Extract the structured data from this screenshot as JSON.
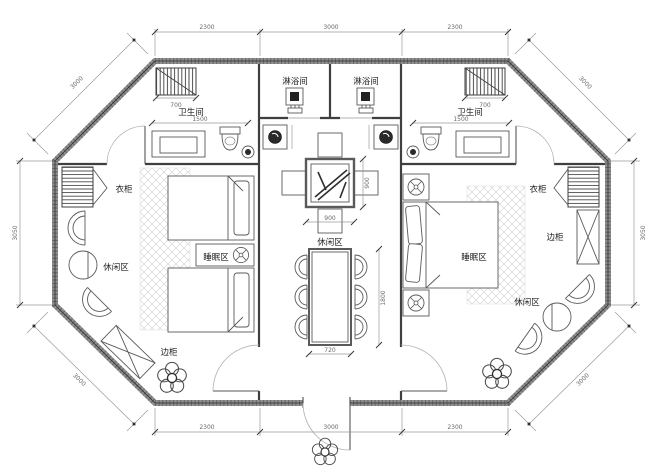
{
  "drawing": {
    "type": "octagonal suite floor plan",
    "background": "#ffffff",
    "wall_color": "#8f8f8f",
    "line_color": "#5a5a5a",
    "dim_color": "#6b6b6b"
  },
  "labels": {
    "shower_left": "淋浴间",
    "shower_right": "淋浴间",
    "bathroom_left": "卫生间",
    "bathroom_right": "卫生间",
    "wardrobe_left": "衣柜",
    "wardrobe_right": "衣柜",
    "sleeping_left": "睡眠区",
    "sleeping_right": "睡眠区",
    "leisure_left": "休闲区",
    "leisure_center": "休闲区",
    "leisure_right": "休闲区",
    "side_cabinet_left": "边柜",
    "side_cabinet_right": "边柜"
  },
  "dimensions": {
    "top_left": "2300",
    "top_center": "3000",
    "top_right": "2300",
    "bottom_left": "2300",
    "bottom_center": "3000",
    "bottom_right": "2300",
    "side_left": "3050",
    "side_right": "3050",
    "diag_top_left": "3000",
    "diag_top_right": "3000",
    "diag_bottom_left": "3000",
    "diag_bottom_right": "3000",
    "bath_left_width": "1500",
    "bath_right_width": "1500",
    "radiator_left": "700",
    "radiator_right": "700",
    "table_width": "900",
    "table_height": "900",
    "dining_width": "720",
    "dining_height": "1800"
  }
}
